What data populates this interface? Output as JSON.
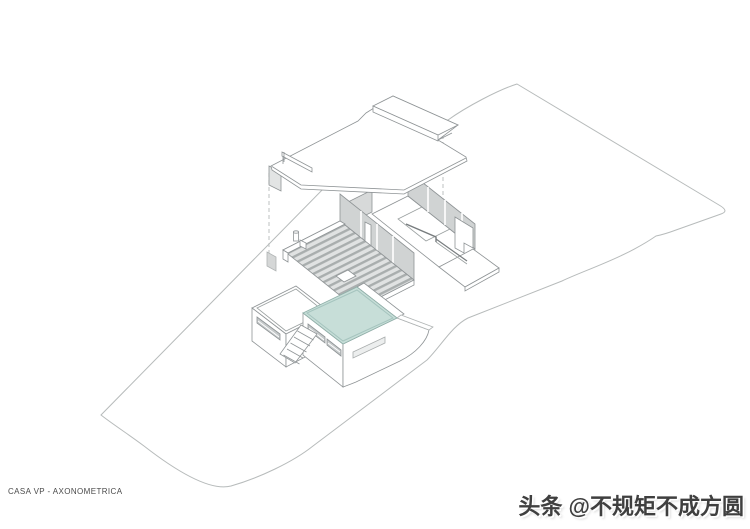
{
  "drawing": {
    "title": "CASA VP - AXONOMETRICA"
  },
  "watermark": {
    "platform": "头条",
    "handle": "@不规矩不成方圆",
    "text": "头条 @不规矩不成方圆"
  },
  "colors": {
    "background": "#ffffff",
    "pool": "#c7ded8",
    "pool_edge": "#8fb0a9",
    "line": "#8f9496",
    "line_light": "#b7bbbb",
    "wall_panel": "#d0d3d3",
    "window_slot": "#c6cacb",
    "deck_light": "#e0e2e2",
    "deck_dark": "#a9aeae",
    "watermark_text": "#3f3f3f",
    "title_text": "#4a4a4a"
  }
}
